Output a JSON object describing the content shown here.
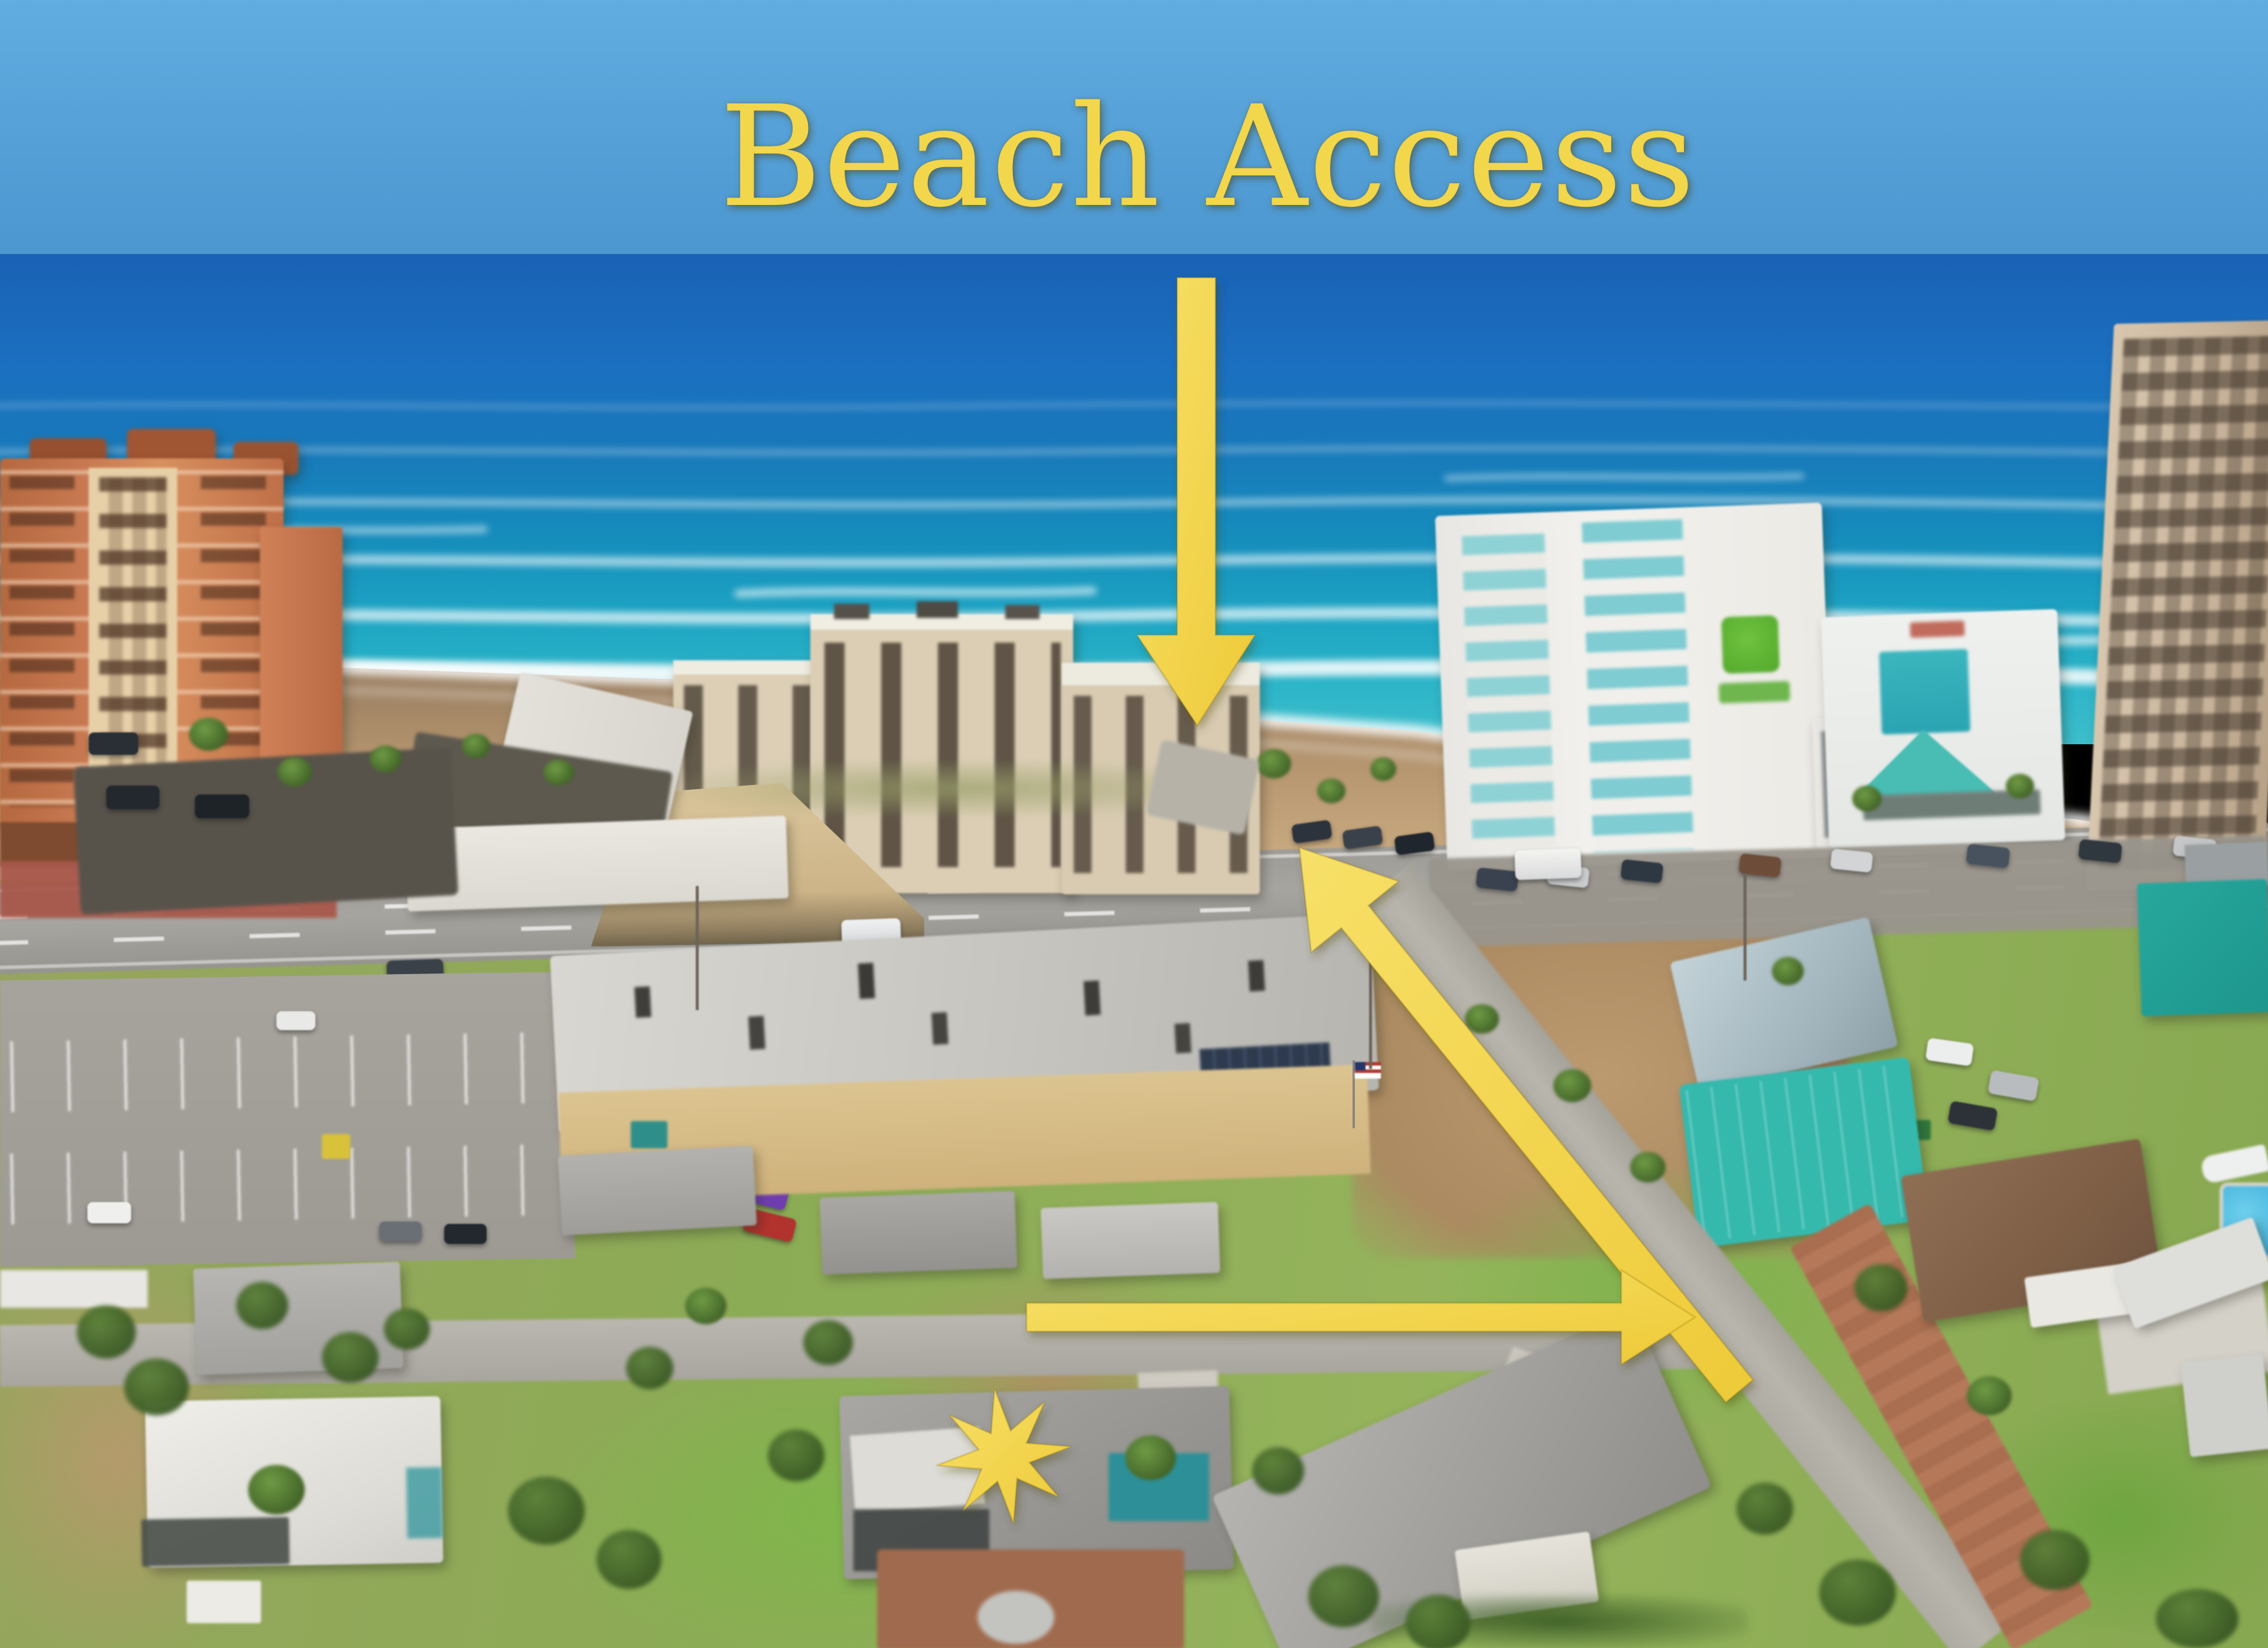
{
  "overlay": {
    "title": "Beach Access",
    "annotation_color": "#F2D64B",
    "markers": [
      "beach-access-down-arrow",
      "route-to-beach-diagonal-arrow",
      "neighborhood-street-right-arrow",
      "subject-property-star"
    ]
  },
  "scene": {
    "palette": {
      "sky": "#55A0D6",
      "ocean_deep": "#1B6CBE",
      "ocean_turquoise": "#2BB3C6",
      "sand": "#C8AC83",
      "grass": "#7CAF4C",
      "asphalt": "#A3A09B",
      "holiday_inn_logo_green": "#5CB531",
      "teal_roof": "#35B9AD",
      "terracotta_condo": "#C97A52"
    }
  }
}
